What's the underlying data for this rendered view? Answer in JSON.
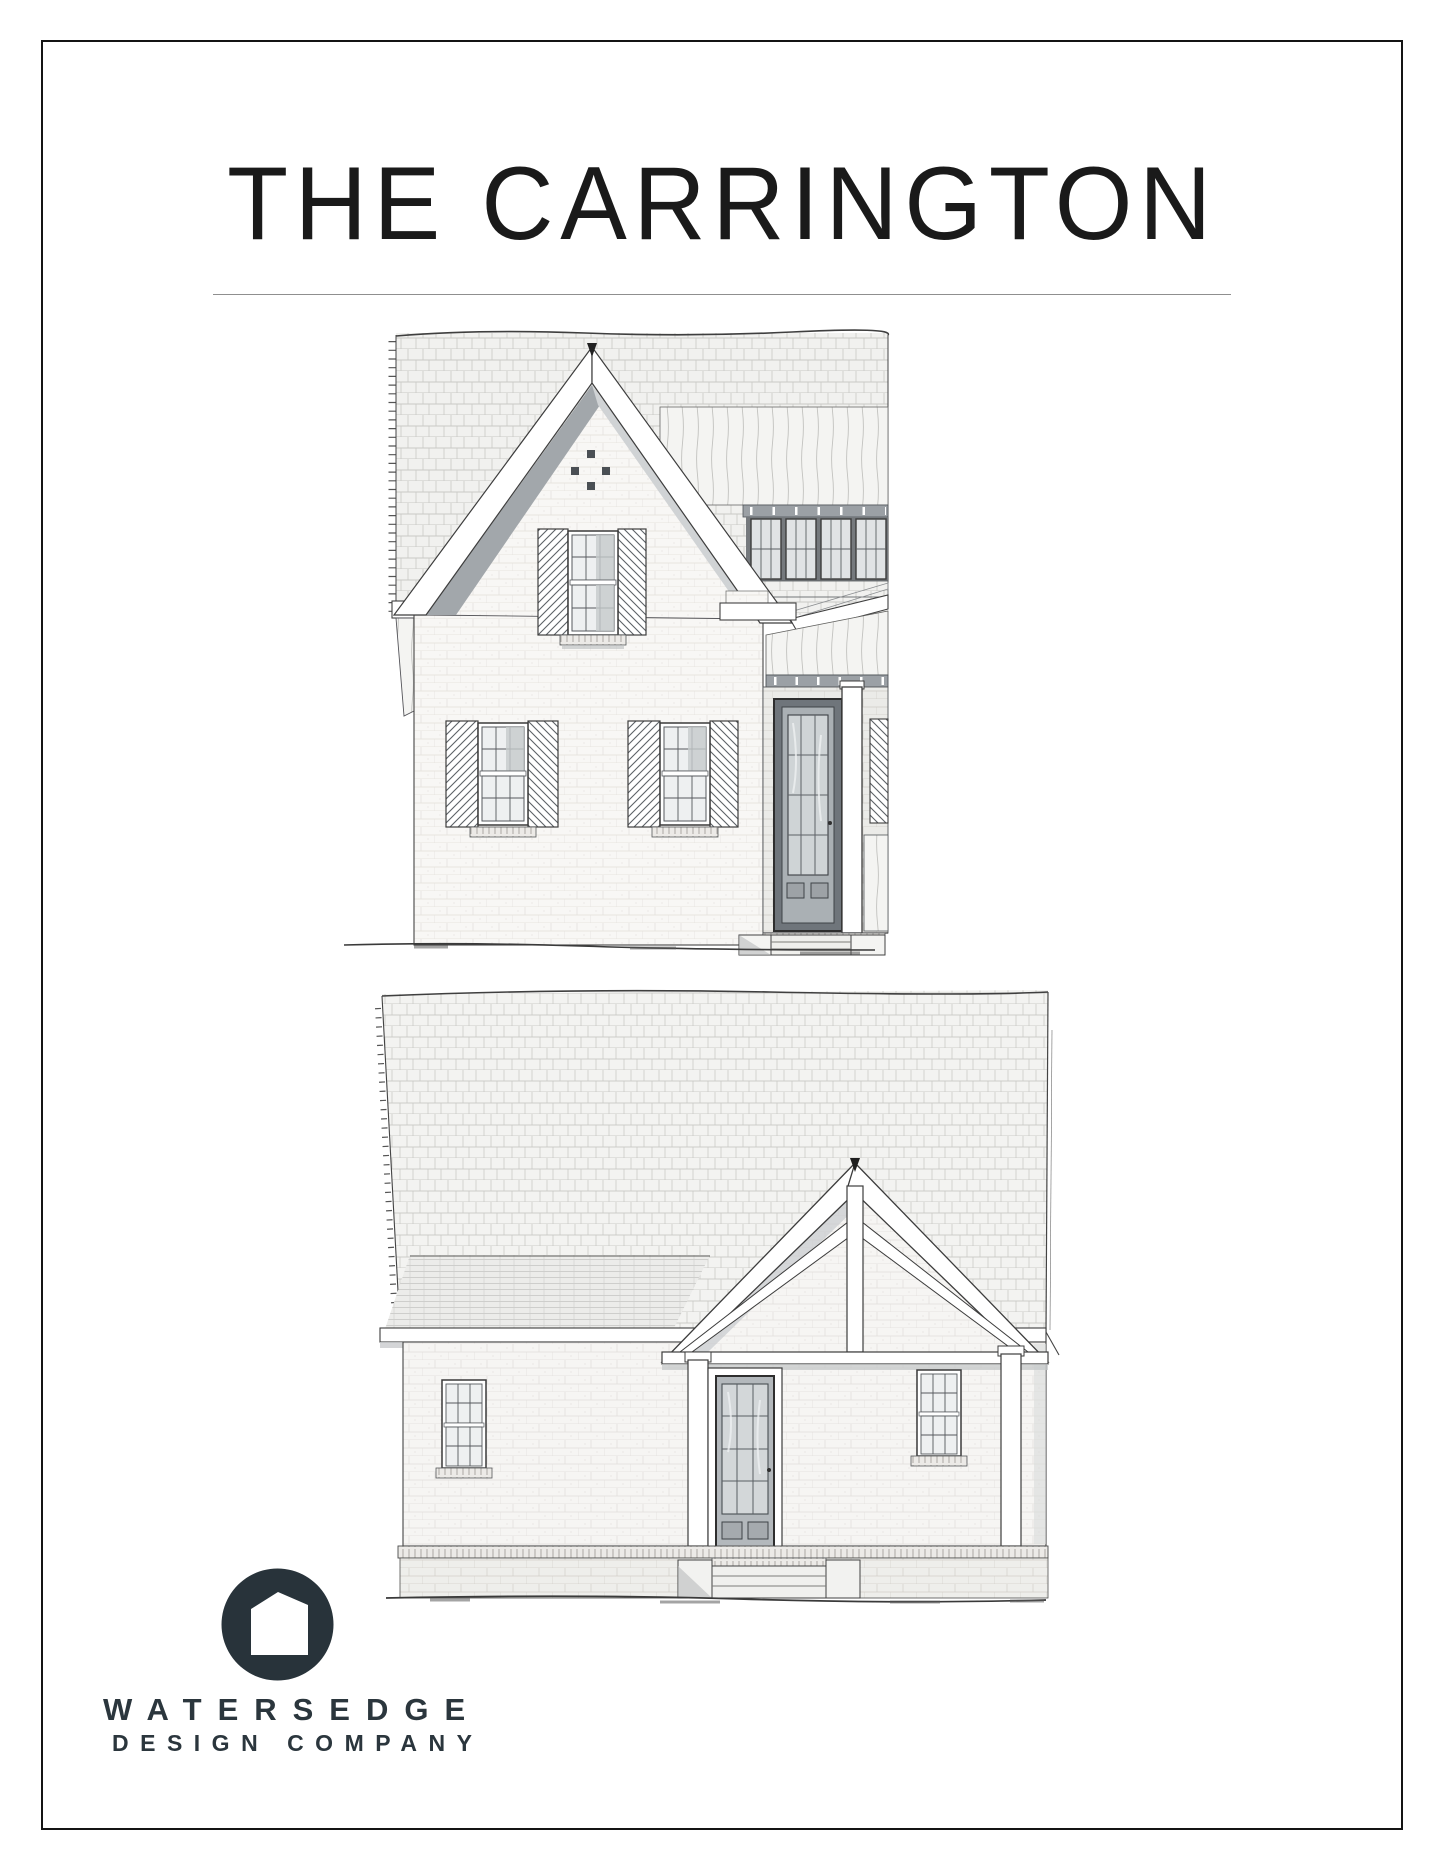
{
  "page": {
    "background": "#ffffff",
    "border_color": "#141414"
  },
  "header": {
    "title": "THE CARRINGTON"
  },
  "figures": {
    "front_elevation": {
      "label": "front-elevation-sketch"
    },
    "rear_elevation": {
      "label": "rear-elevation-sketch"
    }
  },
  "logo": {
    "icon": "house-in-circle-icon",
    "color": "#28333a",
    "line1": "WATERSEDGE",
    "line2": "DESIGN COMPANY"
  }
}
